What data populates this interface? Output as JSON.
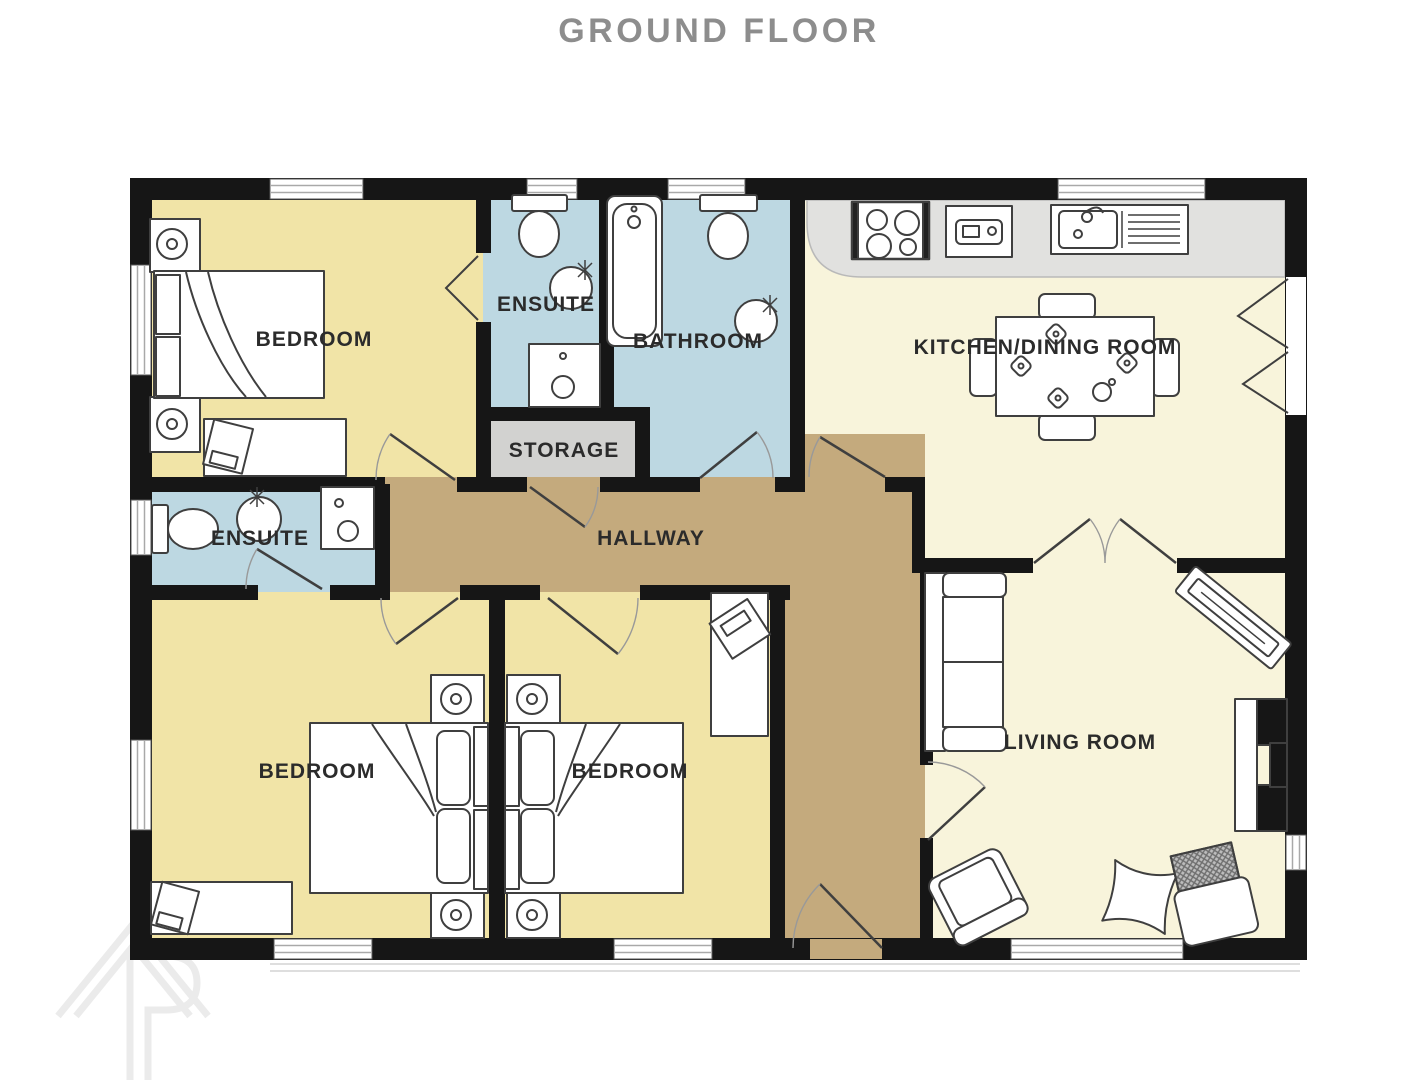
{
  "title": "GROUND FLOOR",
  "floorplan": {
    "rooms": [
      {
        "id": "bedroom-1",
        "label": "BEDROOM",
        "fixtures": [
          "double-bed-icon",
          "nightstand-lamp-icon",
          "nightstand-lamp-icon",
          "dresser-tv-icon"
        ]
      },
      {
        "id": "ensuite-1",
        "label": "ENSUITE",
        "fixtures": [
          "toilet-icon",
          "basin-icon",
          "shower-tray-icon"
        ]
      },
      {
        "id": "bathroom",
        "label": "BATHROOM",
        "fixtures": [
          "bathtub-icon",
          "toilet-icon",
          "basin-icon"
        ]
      },
      {
        "id": "storage",
        "label": "STORAGE",
        "fixtures": []
      },
      {
        "id": "kitchen-dining-room",
        "label": "KITCHEN/DINING ROOM",
        "fixtures": [
          "hob-icon",
          "oven-icon",
          "sink-drainer-icon",
          "dining-table-icon",
          "chair-icon",
          "chair-icon",
          "chair-icon",
          "chair-icon"
        ]
      },
      {
        "id": "hallway",
        "label": "HALLWAY",
        "fixtures": []
      },
      {
        "id": "ensuite-2",
        "label": "ENSUITE",
        "fixtures": [
          "toilet-icon",
          "basin-icon",
          "shower-tray-icon"
        ]
      },
      {
        "id": "bedroom-2",
        "label": "BEDROOM",
        "fixtures": [
          "double-bed-icon",
          "nightstand-lamp-icon",
          "nightstand-lamp-icon",
          "dresser-tv-icon"
        ]
      },
      {
        "id": "bedroom-3",
        "label": "BEDROOM",
        "fixtures": [
          "double-bed-icon",
          "nightstand-lamp-icon",
          "nightstand-lamp-icon",
          "wardrobe-icon"
        ]
      },
      {
        "id": "living-room",
        "label": "LIVING ROOM",
        "fixtures": [
          "sofa-icon",
          "armchair-icon",
          "armchair-icon",
          "armchair-icon",
          "sideboard-icon",
          "fireplace-icon"
        ]
      }
    ],
    "colors": {
      "bedroom": "#F1E4A7",
      "wet_room": "#BDD8E2",
      "hallway": "#C4AA7D",
      "storage": "#D2D2D0",
      "living": "#F8F4DB",
      "wall": "#161616",
      "counter": "#E1E1DF",
      "label": "#2B2B2B",
      "title": "#8D8D8D",
      "watermark": "#EBEBEB"
    }
  }
}
